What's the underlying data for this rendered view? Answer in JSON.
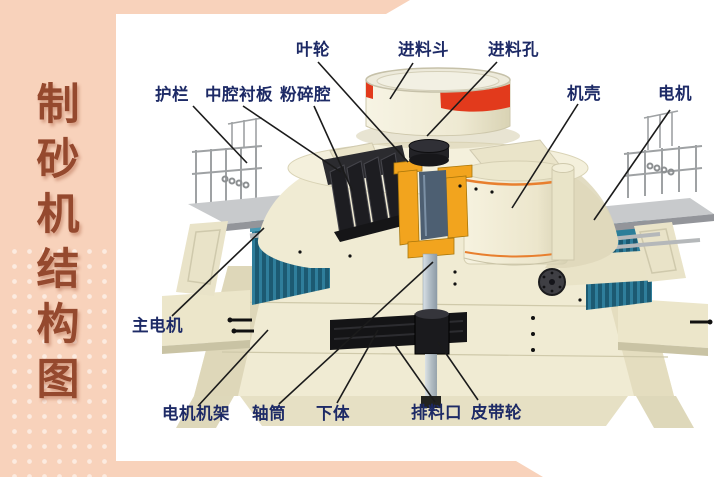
{
  "page_title": "制砂机结构图",
  "sidebar": {
    "chars": [
      "制",
      "砂",
      "机",
      "结",
      "构",
      "图"
    ]
  },
  "diagram": {
    "subject": "sand-making machine cutaway structure",
    "labels": [
      {
        "id": "impeller",
        "text": "叶轮"
      },
      {
        "id": "feed-hopper",
        "text": "进料斗"
      },
      {
        "id": "feed-hole",
        "text": "进料孔"
      },
      {
        "id": "guardrail",
        "text": "护栏"
      },
      {
        "id": "cavity-liner",
        "text": "中腔衬板"
      },
      {
        "id": "crushing-chamber",
        "text": "粉碎腔"
      },
      {
        "id": "casing",
        "text": "机壳"
      },
      {
        "id": "motor",
        "text": "电机"
      },
      {
        "id": "main-motor",
        "text": "主电机"
      },
      {
        "id": "motor-frame",
        "text": "电机机架"
      },
      {
        "id": "shaft-tube",
        "text": "轴筒"
      },
      {
        "id": "lower-body",
        "text": "下体"
      },
      {
        "id": "discharge-port",
        "text": "排料口"
      },
      {
        "id": "belt-pulley",
        "text": "皮带轮"
      }
    ]
  },
  "colors": {
    "peach": "#f8d2bb",
    "title": "#95492e",
    "label": "#1d2a66",
    "leader-line": "#1b1b1b",
    "cream": "#f0ebd3",
    "cream-shade": "#ddd6b7",
    "red-band": "#e23a1c",
    "orange-trim": "#e87f2e",
    "bearing-orange": "#f2a41e",
    "motor-teal": "#25708d",
    "platform-gray": "#c8cacc",
    "dark-part": "#1c1c1e",
    "shaft-gray": "#b7c2ca"
  }
}
